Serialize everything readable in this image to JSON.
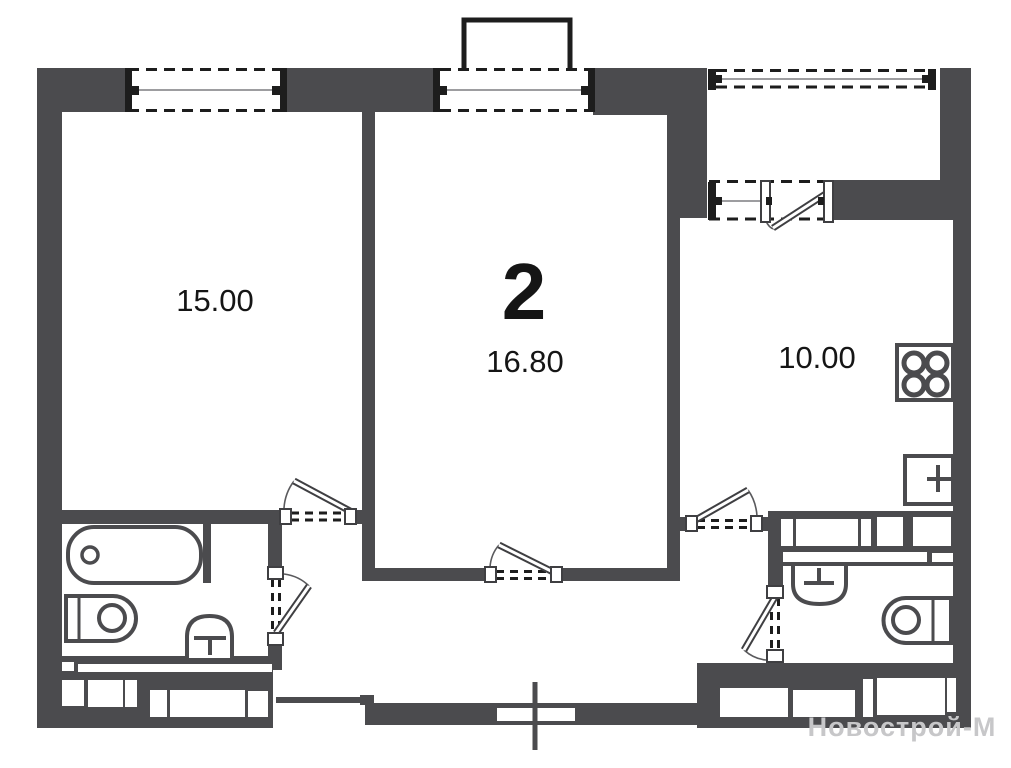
{
  "title": "2-room apartment floor plan",
  "unit": {
    "rooms_count_label": "2"
  },
  "rooms": {
    "living": {
      "area": "15.00"
    },
    "bedroom": {
      "area": "16.80"
    },
    "kitchen": {
      "area": "10.00"
    }
  },
  "watermark": {
    "text": "Новострой-М"
  },
  "colors": {
    "wall": "#4b4b4e",
    "window_frame": "#1d1d1d",
    "label_text": "#151515",
    "watermark": "#c7c7c9"
  },
  "fixture_icons": [
    "bathtub-icon",
    "washer-icon",
    "toilet-icon",
    "washbasin-icon",
    "stove-icon",
    "kitchen-sink-icon",
    "balcony-icon",
    "door-swing-icon",
    "window-icon",
    "section-cross-icon"
  ]
}
